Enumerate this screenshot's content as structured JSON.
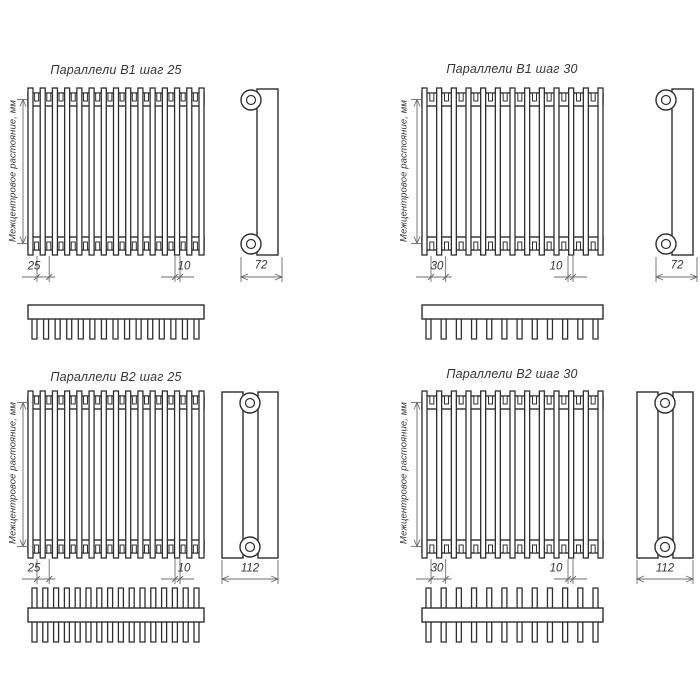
{
  "colors": {
    "background": "#ffffff",
    "line": "#2e2e2e",
    "thin_line": "#6b6b6b",
    "text": "#353535"
  },
  "quadrants": [
    {
      "title": "Параллели В1 шаг 25",
      "variant": "B1",
      "center_distance_label": "Межцентровое растояние, мм",
      "pitch_label": "25",
      "tube_width_label": "10",
      "depth_label": "72",
      "front_tube_count": 15,
      "comb_tooth_count": 15
    },
    {
      "title": "Параллели В1 шаг 30",
      "variant": "B1",
      "center_distance_label": "Межцентровое растояние, мм",
      "pitch_label": "30",
      "tube_width_label": "10",
      "depth_label": "72",
      "front_tube_count": 13,
      "comb_tooth_count": 12
    },
    {
      "title": "Параллели В2 шаг 25",
      "variant": "B2",
      "center_distance_label": "Межцентровое растояние, мм",
      "pitch_label": "25",
      "tube_width_label": "10",
      "depth_label": "112",
      "front_tube_count": 15,
      "comb_tooth_count": 16
    },
    {
      "title": "Параллели В2 шаг 30",
      "variant": "B2",
      "center_distance_label": "Межцентровое растояние, мм",
      "pitch_label": "30",
      "tube_width_label": "10",
      "depth_label": "112",
      "front_tube_count": 13,
      "comb_tooth_count": 12
    }
  ]
}
